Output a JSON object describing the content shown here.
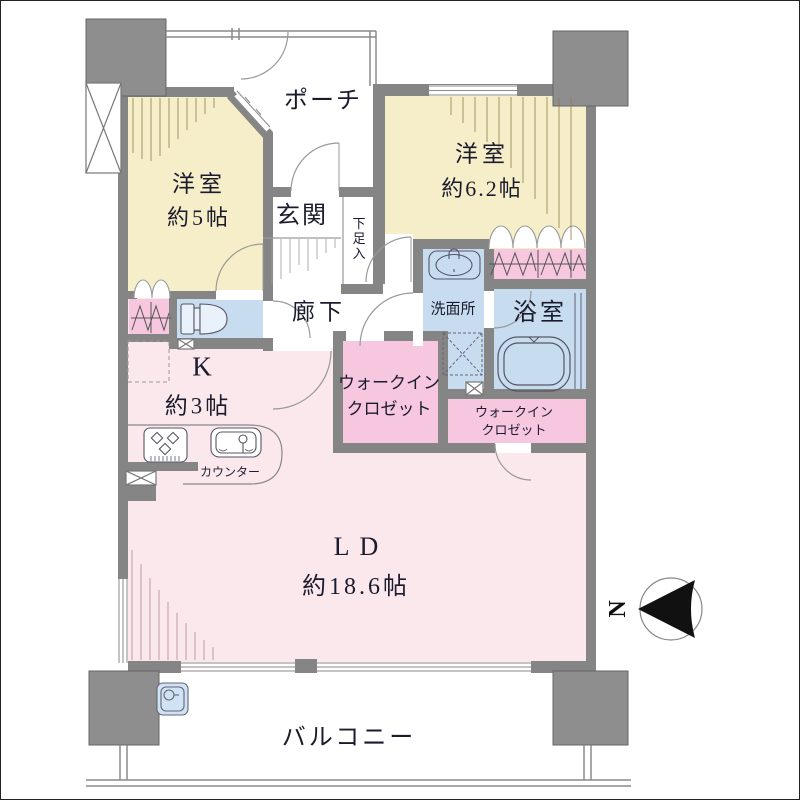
{
  "floorplan": {
    "rooms": {
      "bedroom5": {
        "name": "洋室",
        "size": "約5帖"
      },
      "porch": {
        "name": "ポーチ"
      },
      "bedroom62": {
        "name": "洋室",
        "size": "約6.2帖"
      },
      "entrance": {
        "name": "玄関"
      },
      "shoe_cabinet": {
        "name": "下足入"
      },
      "hallway": {
        "name": "廊下"
      },
      "washroom": {
        "name": "洗面所"
      },
      "bathroom": {
        "name": "浴室"
      },
      "walk_in_closet_1": {
        "line1": "ウォークイン",
        "line2": "クロゼット"
      },
      "walk_in_closet_2": {
        "line1": "ウォークイン",
        "line2": "クロゼット"
      },
      "kitchen": {
        "name": "K",
        "size": "約3帖"
      },
      "counter": {
        "name": "カウンター"
      },
      "living_dining": {
        "name": "LD",
        "size": "約18.6帖"
      },
      "balcony": {
        "name": "バルコニー"
      }
    },
    "compass": {
      "label": "N",
      "direction": "north-left"
    },
    "colors": {
      "wall": "#858585",
      "column": "#8e8e8e",
      "bedroom_cream": "#f6eec9",
      "living_pink": "#fbe8ec",
      "closet_pink": "#f6c7de",
      "wet_area_blue": "#c8dcf0",
      "line": "#9a9a9a"
    }
  }
}
